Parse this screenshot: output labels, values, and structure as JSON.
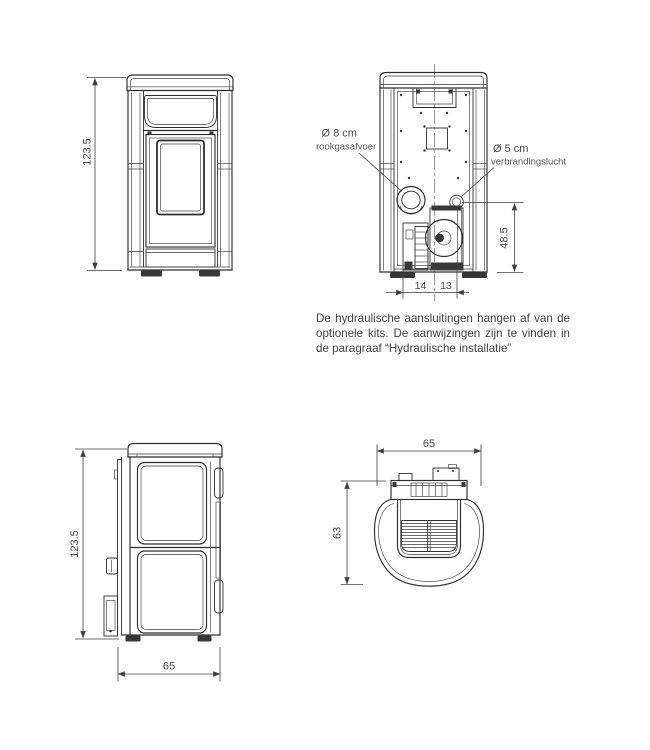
{
  "diagram": {
    "type": "stove-technical-drawing",
    "background": "#ffffff",
    "line_color": "#2e2e2e",
    "text_color": "#474747"
  },
  "front_view": {
    "height_label": "123.5"
  },
  "rear_view": {
    "flue_diameter": "Ø 8 cm",
    "flue_name": "rookgasafvoer",
    "air_diameter": "Ø 5 cm",
    "air_name": "verbrandingslucht",
    "air_height": "48.5",
    "offset_left": "14",
    "offset_right": "13"
  },
  "side_view": {
    "height_label": "123.5",
    "depth_label": "65"
  },
  "top_view": {
    "width_label": "65",
    "depth_label": "63"
  },
  "note": {
    "lines": [
      "De hydraulische aansluitingen hangen af van de",
      "optionele kits. De aanwijzingen zijn te vinden in",
      "de paragraaf “Hydraulische installatie”"
    ]
  }
}
